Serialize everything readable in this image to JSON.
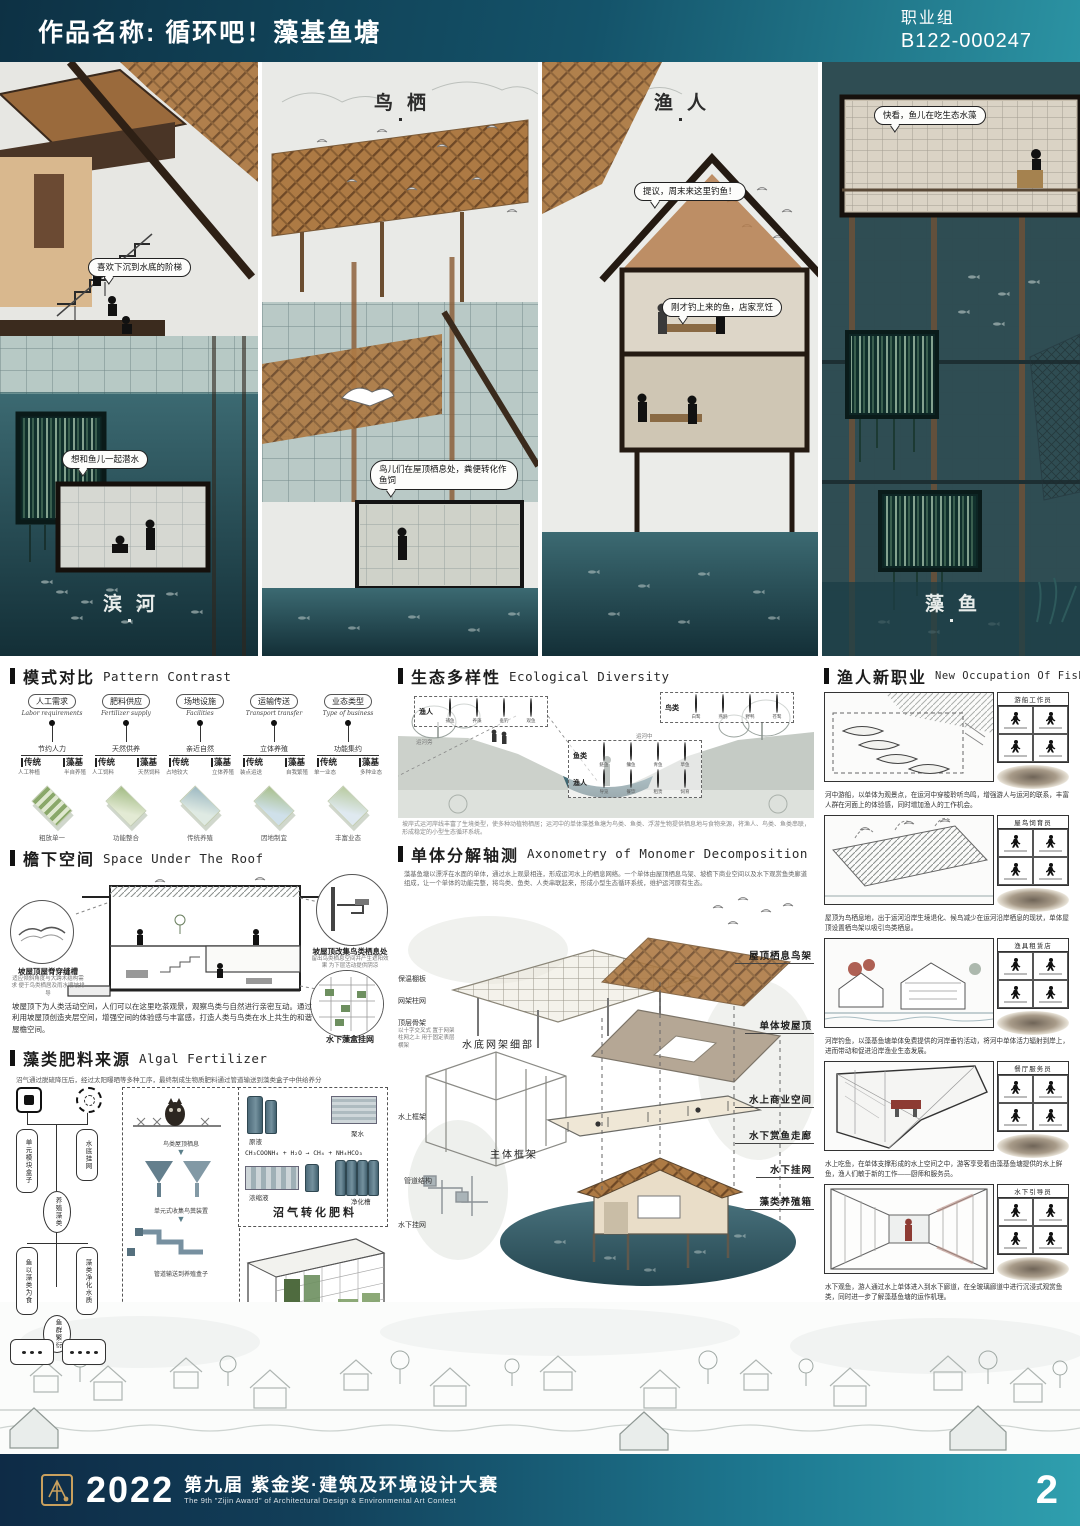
{
  "header": {
    "title": "作品名称: 循环吧！藻基鱼塘",
    "group": "职业组",
    "entry_no": "B122-000247"
  },
  "panels": {
    "p1": {
      "label": "滨河",
      "bubble1": "喜欢下沉到水底的阶梯",
      "bubble2": "想和鱼儿一起潜水"
    },
    "p2": {
      "label": "鸟栖",
      "bubble1": "鸟儿们在屋顶栖息处，粪便转化作鱼饲"
    },
    "p3": {
      "label": "渔人",
      "bubble1": "提议，周末来这里钓鱼！",
      "bubble2": "刚才钓上来的鱼，店家烹饪"
    },
    "p4": {
      "label": "藻鱼",
      "bubble1": "快看，鱼儿在吃生态水藻"
    }
  },
  "pattern": {
    "title_zh": "模式对比",
    "title_en": "Pattern Contrast",
    "columns": [
      {
        "badge": "人工需求",
        "en": "Labor requirements",
        "node": "节约人力",
        "left": "传统",
        "right": "藻基",
        "left_sub": "人工种植",
        "right_sub": "半自养殖",
        "caption": "粗放单一"
      },
      {
        "badge": "肥料供应",
        "en": "Fertilizer supply",
        "node": "天然供养",
        "left": "传统",
        "right": "藻基",
        "left_sub": "人工饲料",
        "right_sub": "天然饲料",
        "caption": "功能整合"
      },
      {
        "badge": "场地设施",
        "en": "Facilities",
        "node": "亲近自然",
        "left": "传统",
        "right": "藻基",
        "left_sub": "占地较大",
        "right_sub": "立体养殖",
        "caption": "传统养殖"
      },
      {
        "badge": "运输传送",
        "en": "Transport transfer",
        "node": "立体养殖",
        "left": "传统",
        "right": "藻基",
        "left_sub": "装点运送",
        "right_sub": "自我繁殖",
        "caption": "因地制宜"
      },
      {
        "badge": "业态类型",
        "en": "Type of business",
        "node": "功能集约",
        "left": "传统",
        "right": "藻基",
        "left_sub": "单一业态",
        "right_sub": "多种业态",
        "caption": "丰富业态"
      }
    ]
  },
  "eco": {
    "title_zh": "生态多样性",
    "title_en": "Ecological Diversity",
    "groups": [
      {
        "label": "渔人",
        "items": [
          "捕鱼",
          "养藻",
          "垂钓",
          "观鱼"
        ]
      },
      {
        "label": "鸟类",
        "items": [
          "白鹭",
          "燕鸥",
          "野鸭",
          "苍鹭"
        ]
      },
      {
        "label": "鱼类",
        "items": [
          "鲢鱼",
          "鳙鱼",
          "青鱼",
          "草鱼"
        ]
      },
      {
        "label": "渔人",
        "items": [
          "导览",
          "餐饮",
          "租赁",
          "饲育"
        ]
      }
    ],
    "cap_left": "运河旁",
    "cap_mid": "运河中",
    "note": "坡岸式运河岸线丰富了生境类型，使多种动植物栖居；运河中的单体藻基鱼塘为鸟类、鱼类、浮游生物提供栖息地与食物来源，将渔人、鸟类、鱼类串联，形成稳定的小型生态循环系统。"
  },
  "roof": {
    "title_zh": "檐下空间",
    "title_en": "Space Under The Roof",
    "callout_left": "坡屋顶屋脊穿缝槽",
    "callout_left_sub": "适应倾斜角度与大跨木结构需求 便于鸟类栖居及雨水顺坡排导",
    "callout_right": "坡屋顶改集鸟类栖息处",
    "callout_right_sub": "留出鸟类栖息空间并产生遮阳效果 为下层活动提供阴凉",
    "callout_bottom": "水下藻盒挂网",
    "para": "坡屋顶下为人类活动空间，人们可以在这里吃茶观景，观察鸟类与自然进行亲密互动。通过利用坡屋顶创造夹层空间，增强空间的体验感与丰富感，打造人类与鸟类在水上共生的和谐屋檐空间。"
  },
  "algal": {
    "title_zh": "藻类肥料来源",
    "title_en": "Algal Fertilizer",
    "intro": "沼气通过脱硫降压后，经过太阳曝晒等多种工序，最终制成生物质肥料通过管道输送到藻类盒子中供给养分",
    "flow": [
      "单元模块盒子",
      "水底挂网",
      "养殖藻类",
      "鱼以藻类为食",
      "藻类净化水质",
      "鱼群繁衍"
    ],
    "mid_steps": [
      "鸟类屋顶栖息",
      "单元式收集鸟粪装置",
      "管道输送到养殖盒子"
    ],
    "mid_caption": "鸟粪供养藻类",
    "right_labels": [
      "原液",
      "聚水",
      "浓缩液",
      "净化槽"
    ],
    "formula": "CH₃COONH₄ + H₂O → CH₄ + NH₄HCO₃",
    "right_caption": "沼气转化肥料",
    "box_caption": "藻类养殖盒"
  },
  "axon": {
    "title_zh": "单体分解轴测",
    "title_en": "Axonometry of Monomer Decomposition",
    "intro": "藻基鱼塘以漂浮在水面的单体，通过水上观景相连，形成运河水上的栖息网络。一个单体由屋顶栖息鸟架、坡檐下商业空间以及水下观赏鱼类廊道组成，让一个单体的功能完整，将鸟类、鱼类、人类串联起来，形成小型生态循环系统，维护运河原有生态。",
    "l1": "保温棚板",
    "l2": "网架柱网",
    "l3": "顶层骨架",
    "l3_note": "以十字交叉式 置于网架柱网之上 用于固定表层横架",
    "l4": "水底网架细部",
    "l5": "水上框架",
    "l6": "水下挂网",
    "l7": "主体框架",
    "l8": "管道结构",
    "r1": "屋顶栖息鸟架",
    "r2": "单体坡屋顶",
    "r3": "水上商业空间",
    "r4": "水下赏鱼走廊",
    "r5": "水下挂网",
    "r6": "藻类养殖箱"
  },
  "fisher": {
    "title_zh": "渔人新职业",
    "title_en": "New Occupation Of Fisherman",
    "jobs": [
      {
        "tag": "游船工作员",
        "desc": "河中游船，以单体为观景点，在运河中穿梭聆听鸟鸣，增强游人与运河的联系，丰富人群在河面上的体验感，同时增加渔人的工作机会。"
      },
      {
        "tag": "屋鸟饲育员",
        "desc": "屋顶为鸟栖息地，出于运河沿岸生境退化、候鸟减少在运河沿岸栖息的现状，单体屋顶设置栖鸟架以吸引鸟类栖息。"
      },
      {
        "tag": "渔具租赁店",
        "desc": "河岸钓鱼，以藻基鱼塘单体免费提供的河岸垂钓活动，将河中单体活力辐射到岸上，进而带动和促进沿岸渔业生态发展。"
      },
      {
        "tag": "餐厅服务员",
        "desc": "水上吃鱼，在单体支撑形成的水上空间之中，游客享受着由藻基鱼塘提供的水上鲜鱼，渔人们敏于新的工作——厨师和服务员。"
      },
      {
        "tag": "水下引导员",
        "desc": "水下观鱼，游人通过水上单体进入到水下廊道，在全玻璃廊道中进行沉浸式观赏鱼类，同时进一步了解藻基鱼塘的运作机理。"
      }
    ]
  },
  "footer": {
    "year": "2022",
    "title": "第九届 紫金奖·建筑及环境设计大赛",
    "subtitle": "The 9th \"Zijin Award\" of Architectural Design & Environmental Art Contest",
    "page": "2"
  }
}
